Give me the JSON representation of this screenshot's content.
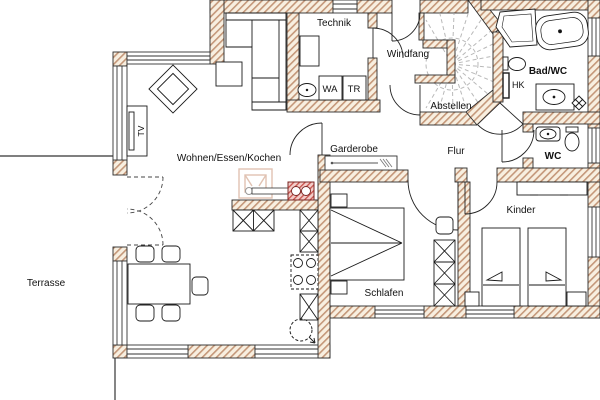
{
  "plan": {
    "type": "floor-plan",
    "rooms": {
      "technik": "Technik",
      "windfang": "Windfang",
      "abstellen": "Abstellen",
      "bad_wc": "Bad/WC",
      "wc": "WC",
      "flur": "Flur",
      "garderobe": "Garderobe",
      "wohnen": "Wohnen/Essen/Kochen",
      "schlafen": "Schlafen",
      "kinder": "Kinder",
      "terrasse": "Terrasse"
    },
    "appliances": {
      "washer": "WA",
      "dryer": "TR",
      "radiator": "HK",
      "tv": "TV"
    },
    "colors": {
      "wall_fill": "#f8efe0",
      "wall_hatch": "#c49779",
      "outline": "#2b2b2b",
      "stair_tread": "#b9b9b9",
      "chimney_fill": "#f3cdc9",
      "chimney_line": "#c8524c",
      "stove_line": "#e0c2b2"
    }
  }
}
